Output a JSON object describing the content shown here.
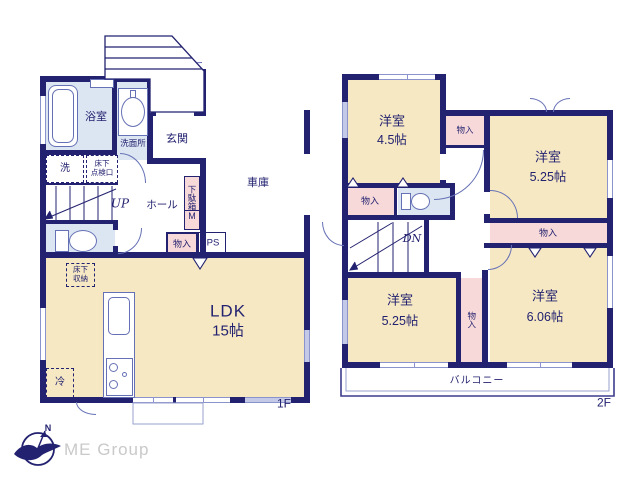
{
  "colors": {
    "wall": "#232270",
    "room_beige": "#f6e8c3",
    "room_pink": "#f8d9d9",
    "room_blue": "#dbe6f2",
    "logo_gray": "#c9c9c9"
  },
  "floor1": {
    "floor_label": "1F",
    "bathroom": "浴室",
    "washroom": "洗面所",
    "entrance": "玄関",
    "laundry": "洗",
    "hatch_line1": "床下",
    "hatch_line2": "点検口",
    "stairs_up": "UP",
    "hall": "ホール",
    "shoe_cabinet": "下駄箱",
    "shoe_cabinet_mirror": "M",
    "storage": "物入",
    "pipe_space": "PS",
    "garage": "車庫",
    "underfloor_line1": "床下",
    "underfloor_line2": "収納",
    "ldk": "LDK",
    "ldk_size": "15帖",
    "refrigerator": "冷"
  },
  "floor2": {
    "floor_label": "2F",
    "room1": "洋室",
    "room1_size": "4.5帖",
    "room2": "洋室",
    "room2_size": "5.25帖",
    "room3": "洋室",
    "room3_size": "5.25帖",
    "room4": "洋室",
    "room4_size": "6.06帖",
    "closet1": "物入",
    "closet2": "物入",
    "closet3": "物入",
    "closet4": "物入",
    "stairs_down": "DN",
    "balcony": "バルコニー"
  },
  "logo": {
    "company": "ME Group",
    "compass_north": "N"
  }
}
